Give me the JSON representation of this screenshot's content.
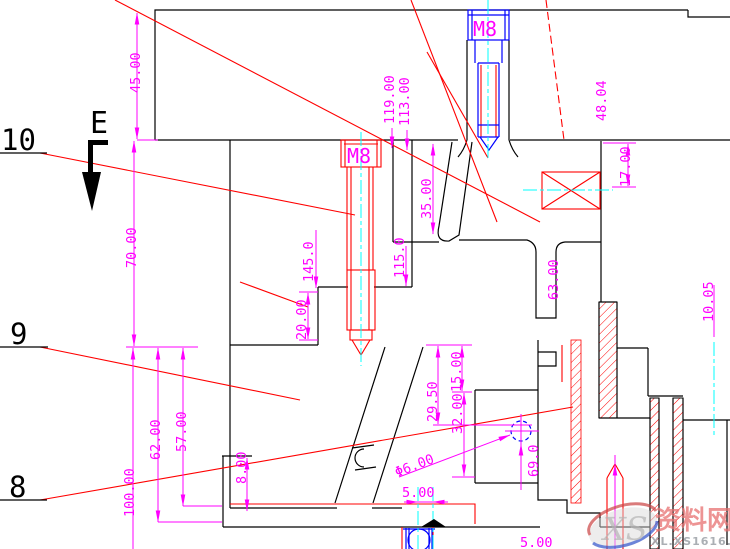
{
  "drawing": {
    "section_label": "E",
    "part_labels": {
      "p10": "10",
      "p9": "9",
      "p8": "8"
    },
    "bolt_labels": {
      "top": "M8",
      "middle": "M8"
    },
    "dimensions": {
      "d45": "45.00",
      "d70": "70.00",
      "d100": "100.00",
      "d62": "62.00",
      "d57": "57.00",
      "d119": "119.00",
      "d113": "113.00",
      "d48": "48.04",
      "d17": "17.00",
      "d35": "35.00",
      "d145": "145.0",
      "d115": "115.0",
      "d20": "20.00",
      "d63": "63.00",
      "d1005": "10.05",
      "d800": "8.00",
      "d2950": "29.50",
      "d1500": "15.00",
      "d3200": "32.00",
      "dphi6": "Φ6.00",
      "d690": "69.0",
      "d5a": "5.00",
      "d5b": "5.00"
    },
    "watermark": {
      "logo": "XS",
      "name": "资料网",
      "url": "XL.XS1616.COM"
    },
    "colors": {
      "dimension": "#FF00FF",
      "outline": "#000000",
      "leader": "#FF0000",
      "centerline": "#00FFFF",
      "bolt_top": "#0000FF",
      "bolt_mid": "#FF0000",
      "watermark_name": "#E87070",
      "watermark_url": "#9AA0A6"
    }
  }
}
